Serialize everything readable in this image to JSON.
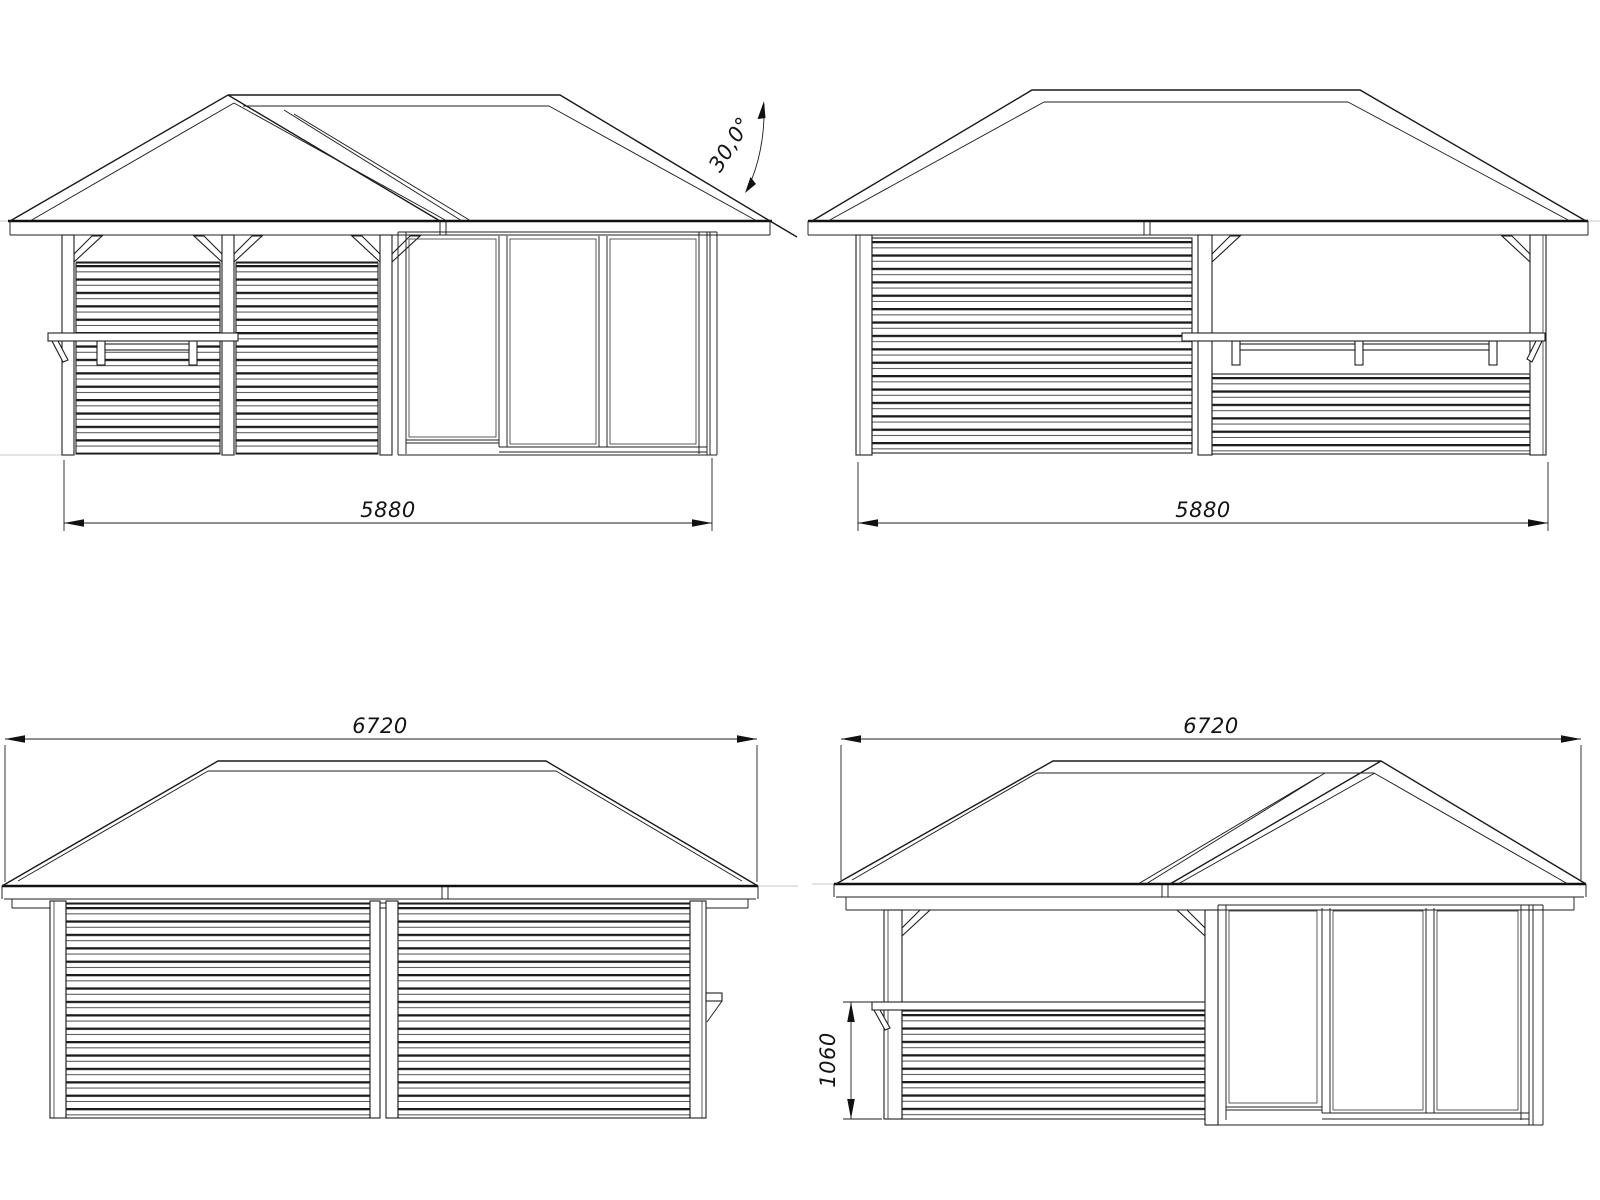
{
  "drawing": {
    "background": "#ffffff",
    "line_color": "#1a1a1a",
    "views": {
      "front_elevation": {
        "width_label": "5880",
        "roof_angle_label": "30,0°"
      },
      "back_elevation": {
        "width_label": "5880"
      },
      "left_side_elevation": {
        "width_label": "6720"
      },
      "right_side_elevation": {
        "width_label": "6720",
        "bar_counter_height_label": "1060"
      }
    }
  }
}
